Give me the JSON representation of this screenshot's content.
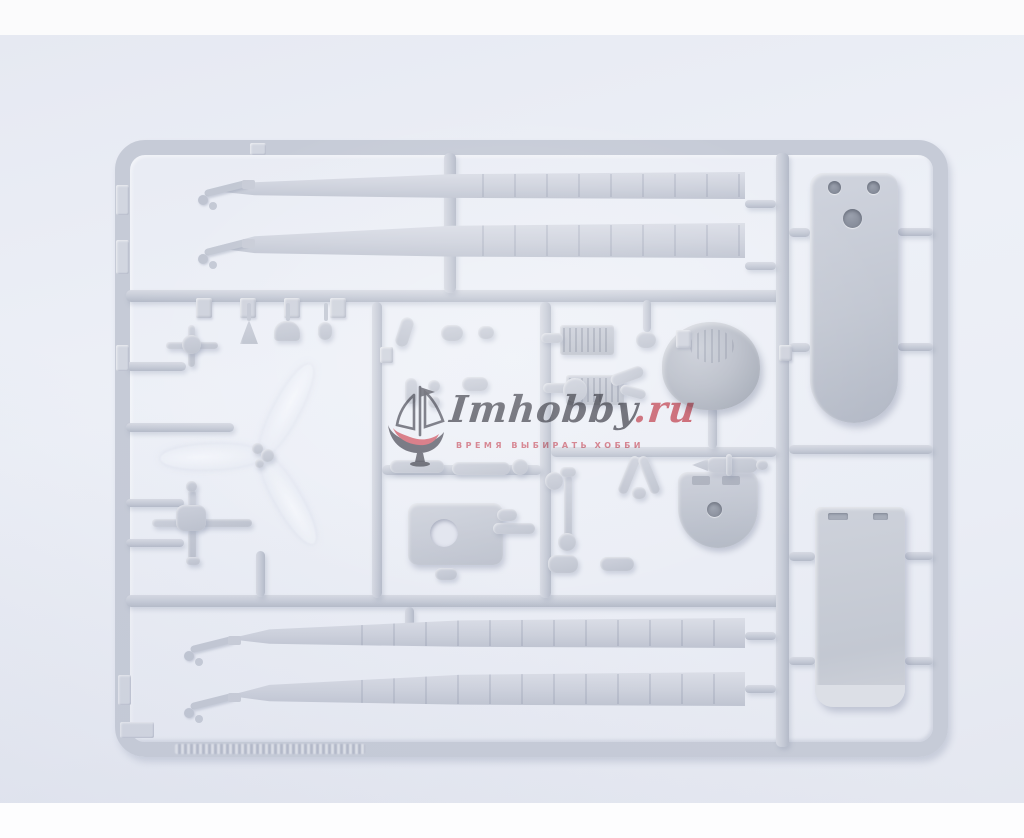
{
  "meta": {
    "type": "product-photo",
    "subject": "Light gray injection-molded plastic sprue with helicopter model kit parts on a pale blue background"
  },
  "photo": {
    "background_color": "#eaedf5",
    "letterbox_color": "#fbfbfc",
    "sprue_color": "#c6cbd7",
    "part_color": "#cdd1dc"
  },
  "watermark": {
    "logo": "sailing-ship-icon",
    "brand": "Imhobby",
    "tld": ".ru",
    "tagline_left": "ВРЕМЯ ВЫБИРАТЬ",
    "tagline_right": "ХОББИ",
    "brand_color": "#53535c",
    "accent_color": "#d45562",
    "tagline_color": "#de6d79"
  },
  "sprue": {
    "parts": [
      "main-rotor-blade-upper-1",
      "main-rotor-blade-upper-2",
      "main-rotor-blade-lower-1",
      "main-rotor-blade-lower-2",
      "vertical-fin-panel",
      "rectangular-panel",
      "dome-fairing",
      "rounded-mount-plate",
      "gearbox-housing",
      "three-blade-tail-rotor",
      "rotor-hub-cross",
      "swashplate-cross",
      "striped-radiator-blocks",
      "assorted-small-detail-parts",
      "embossed-part-number-tags"
    ]
  }
}
